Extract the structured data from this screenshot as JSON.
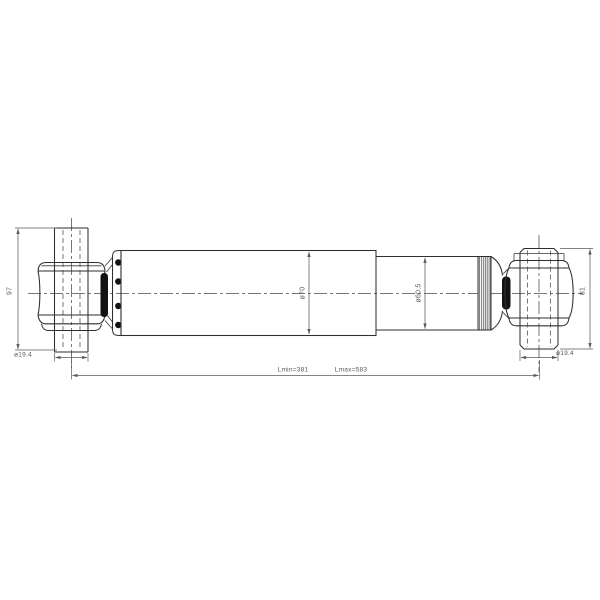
{
  "drawing": {
    "type": "shock-absorber-technical-drawing",
    "dimensions": {
      "left_pin_length": "97",
      "left_pin_diameter": "ø19.4",
      "body_diameter": "ø70",
      "inner_tube_diameter": "ø60.5",
      "right_pin_length": "81",
      "right_pin_diameter": "ø19.4",
      "length_min": "Lmin=381",
      "length_max": "Lmax=583"
    },
    "colors": {
      "background": "#ffffff",
      "line": "#2e2e2e",
      "dimension": "#5a5a5a",
      "solid_fill": "#121212"
    }
  }
}
